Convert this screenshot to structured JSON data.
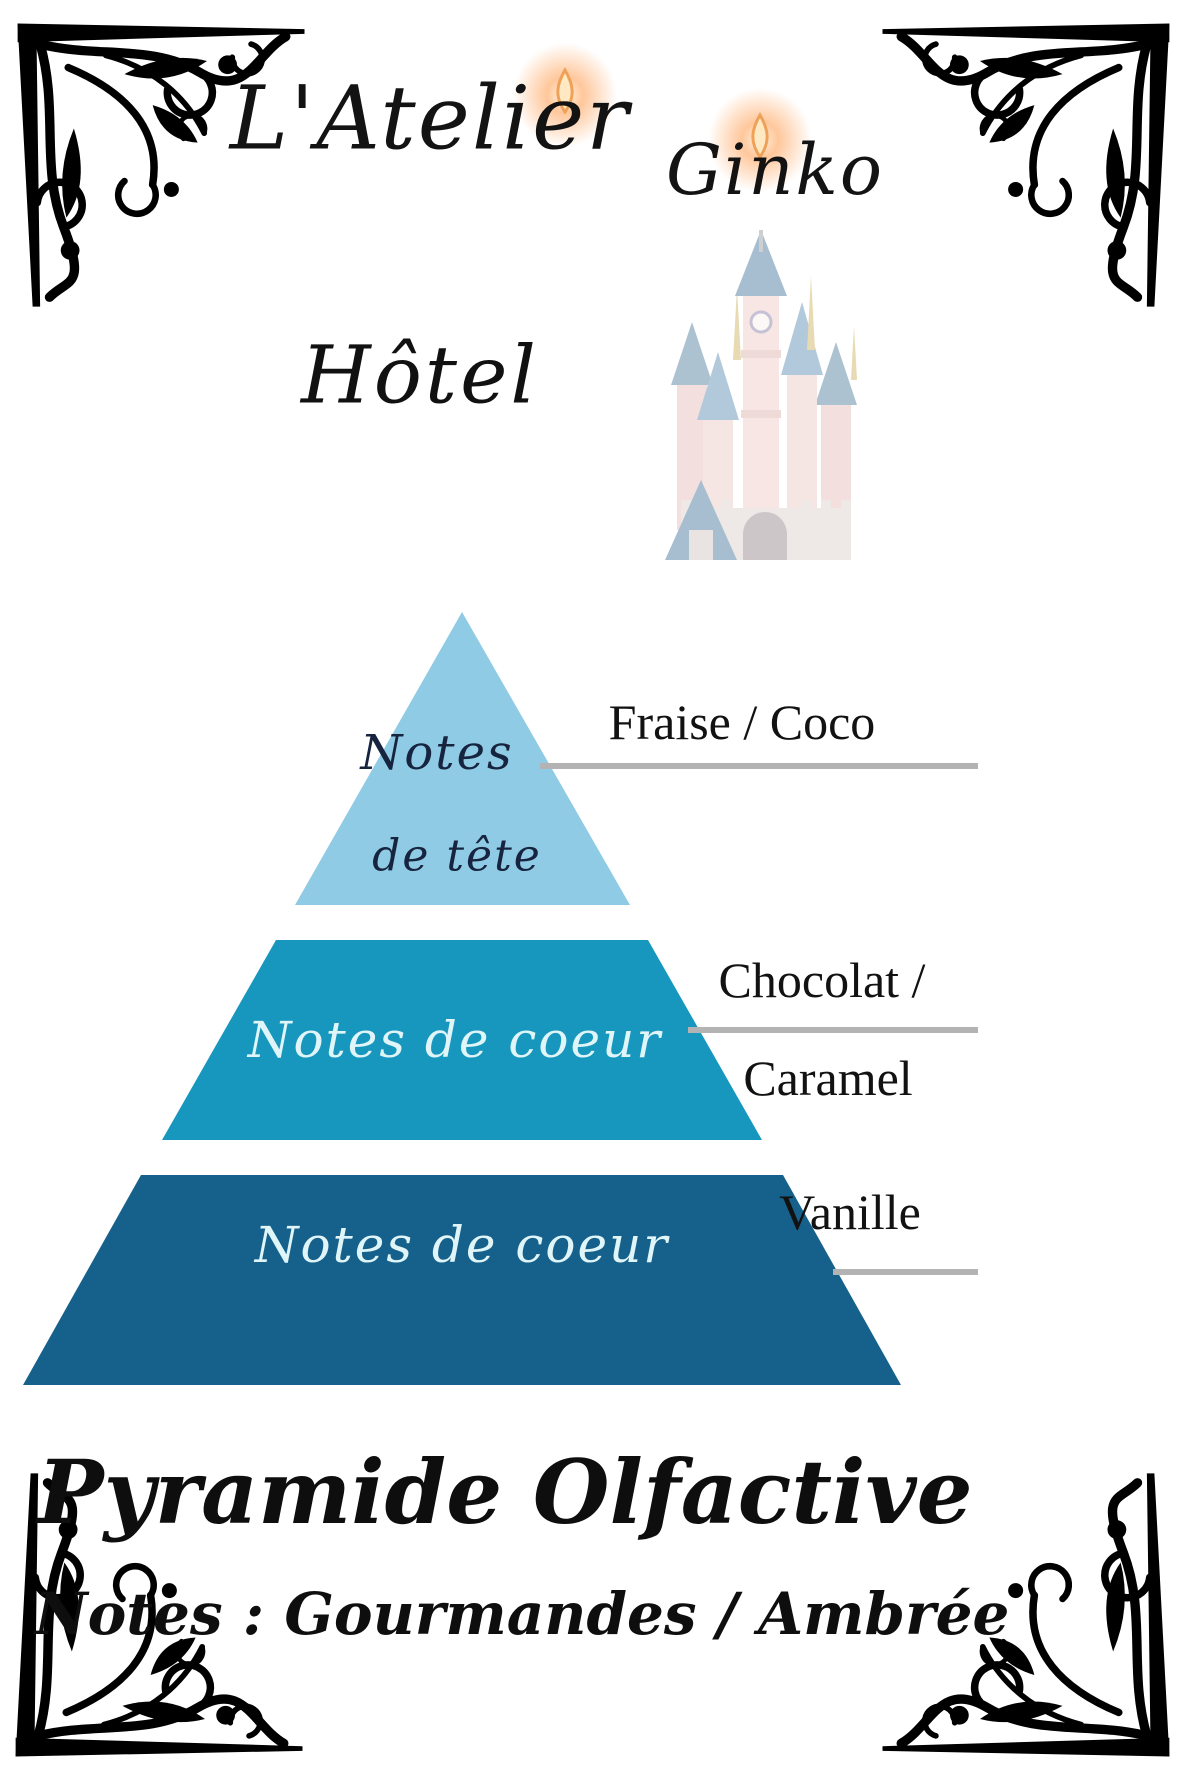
{
  "page": {
    "background": "#ffffff"
  },
  "brand": {
    "name_part1": "L'Atelier",
    "name_part2": "Ginko"
  },
  "product": {
    "title": "Hôtel"
  },
  "pyramid": {
    "tiers": [
      {
        "position": "top",
        "color": "#8FCBE4",
        "text_color": "#16243F",
        "label_line1": "Notes",
        "label_line2": "de tête",
        "note": "Fraise / Coco"
      },
      {
        "position": "middle",
        "color": "#1897BE",
        "text_color": "#DFF5F7",
        "label": "Notes de coeur",
        "note_line1": "Chocolat /",
        "note_line2": "Caramel"
      },
      {
        "position": "bottom",
        "color": "#16618B",
        "text_color": "#DFF5F7",
        "label": "Notes de coeur",
        "note": "Vanille"
      }
    ],
    "connector_color": "#B3B3B3"
  },
  "footer": {
    "title": "Pyramide Olfactive",
    "subtitle": "Notes : Gourmandes / Ambrée"
  },
  "decor": {
    "flame_icon": "candle-flame",
    "castle_illustration": "fairy-tale-castle",
    "corner_ornament": "floral-flourish",
    "flame_color": "#F5A45B",
    "castle_wall_color": "#E3B7B2",
    "castle_roof_color": "#4A7FAE"
  }
}
